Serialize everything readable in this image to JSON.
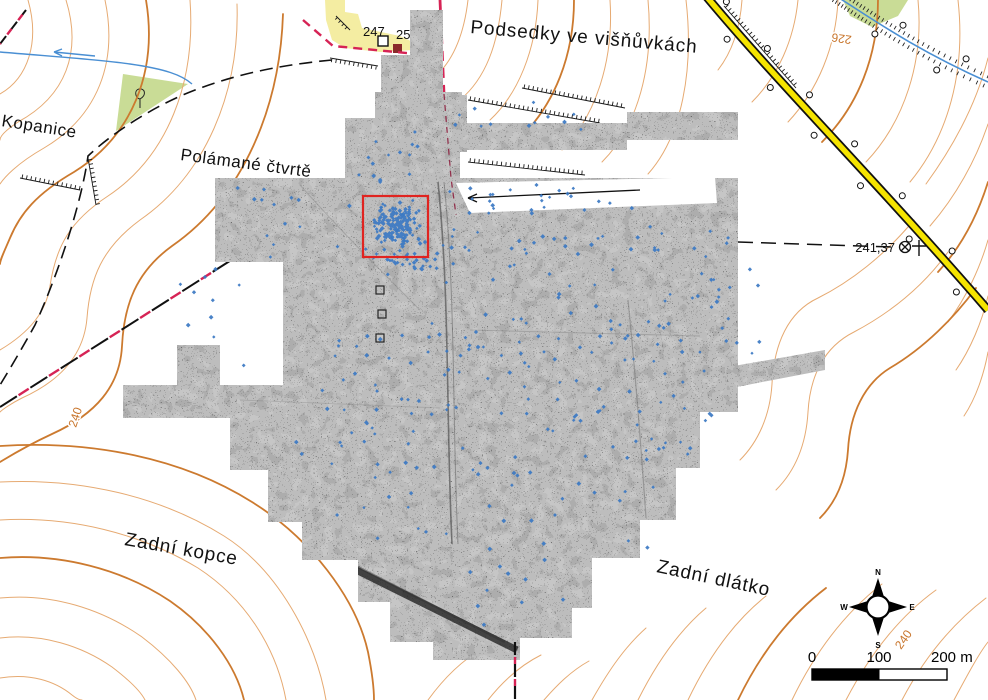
{
  "labels": {
    "podsedky": "Podsedky ve višňůvkách",
    "polamane": "Polámané čtvrtě",
    "kopanice": "Kopanice",
    "zadni_kopce": "Zadní kopce",
    "zadni_dlatko": "Zadní dlátko",
    "partial_field": "o křiv"
  },
  "elevations": {
    "spot_a": "247",
    "spot_b": "253",
    "trig_point": "241,37"
  },
  "contour_labels": {
    "northeast": "226",
    "west": "240",
    "southeast": "240"
  },
  "scale_bar": {
    "start": "0",
    "mid": "100",
    "end": "200 m"
  },
  "compass": {
    "n": "N",
    "e": "E",
    "s": "S",
    "w": "W"
  },
  "colors": {
    "contour_light": "#e6aa72",
    "contour_index": "#cc7a2f",
    "road_fill": "#f5e400",
    "boundary_magenta": "#d62355",
    "stream_blue": "#4a8fd3",
    "vegetation_green": "#c9dc96",
    "quarry_yellow": "#f4eda2",
    "survey_gray": "#c6c6c6",
    "find_spot_blue": "#3b78c3",
    "highlight_red": "#e02420"
  },
  "highlight": {
    "x": 363,
    "y": 196,
    "width": 65,
    "height": 61
  },
  "find_spots": {
    "marker": "diamond",
    "clusters": [
      {
        "type": "gauss",
        "cx": 396,
        "cy": 224,
        "rx": 25,
        "ry": 25,
        "n": 165
      },
      {
        "type": "gauss",
        "cx": 404,
        "cy": 260,
        "rx": 40,
        "ry": 16,
        "n": 30
      },
      {
        "type": "uniform",
        "x": 350,
        "y": 124,
        "w": 105,
        "h": 58,
        "n": 14
      },
      {
        "type": "uniform",
        "x": 455,
        "y": 100,
        "w": 150,
        "h": 30,
        "n": 12
      },
      {
        "type": "uniform",
        "x": 225,
        "y": 185,
        "w": 200,
        "h": 75,
        "n": 26
      },
      {
        "type": "uniform",
        "x": 178,
        "y": 262,
        "w": 70,
        "h": 115,
        "n": 10
      },
      {
        "type": "uniform",
        "x": 445,
        "y": 182,
        "w": 200,
        "h": 34,
        "n": 26
      },
      {
        "type": "uniform",
        "x": 430,
        "y": 225,
        "w": 300,
        "h": 135,
        "n": 85
      },
      {
        "type": "uniform",
        "x": 295,
        "y": 330,
        "w": 420,
        "h": 125,
        "n": 105
      },
      {
        "type": "uniform",
        "x": 330,
        "y": 455,
        "w": 330,
        "h": 95,
        "n": 42
      },
      {
        "type": "uniform",
        "x": 470,
        "y": 555,
        "w": 100,
        "h": 75,
        "n": 10
      },
      {
        "type": "uniform",
        "x": 735,
        "y": 250,
        "w": 45,
        "h": 105,
        "n": 5
      }
    ]
  }
}
